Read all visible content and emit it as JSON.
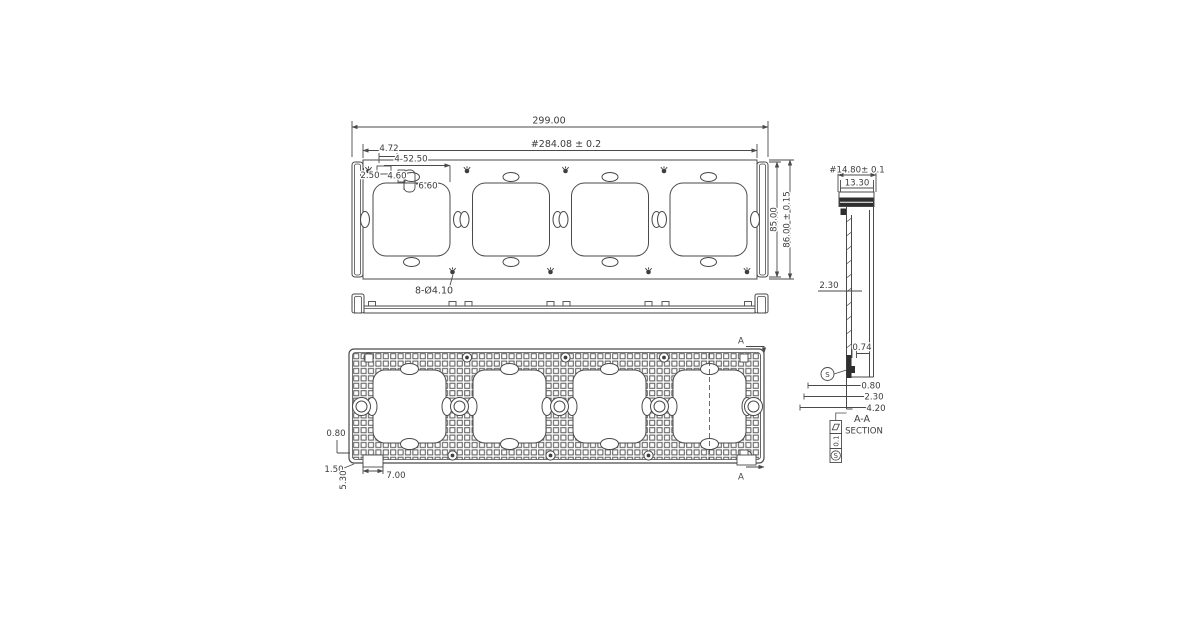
{
  "title": "four-gang wall-plate mounting frame engineering drawing",
  "colors": {
    "line": "#4a4a4a",
    "text": "#3c3c3c",
    "dark_fill": "#2f2f2f",
    "background": "#ffffff"
  },
  "front_view": {
    "overall_width": "299.00",
    "mount_width": "#284.08 ± 0.2",
    "tab_offset": "4.72",
    "hole_edge_offset": "2.50",
    "opening_size": "4-52.50",
    "notch_width": "4.60",
    "notch_depth": "6.60",
    "height_inner": "85.00",
    "height_outer": "86.00 ± 0.15",
    "hole_callout": "8-Ø4.10"
  },
  "back_view": {
    "rib_dim": "0.80",
    "lip_dim": "1.50",
    "foot_height": "5.30",
    "foot_width": "7.00",
    "section_label_top": "A",
    "section_label_bottom": "A"
  },
  "section_view": {
    "depth_overall": "#14.80± 0.1",
    "rim_width": "13.30",
    "wall_thickness": "2.30",
    "step_depth": "0.74",
    "datum_label": "S",
    "base_dim_1": "0.80",
    "base_dim_2": "2.30",
    "base_dim_3": "4.20",
    "label": "A-A",
    "sublabel": "SECTION",
    "tolerance_value": "0.1",
    "tolerance_datum": "S"
  }
}
